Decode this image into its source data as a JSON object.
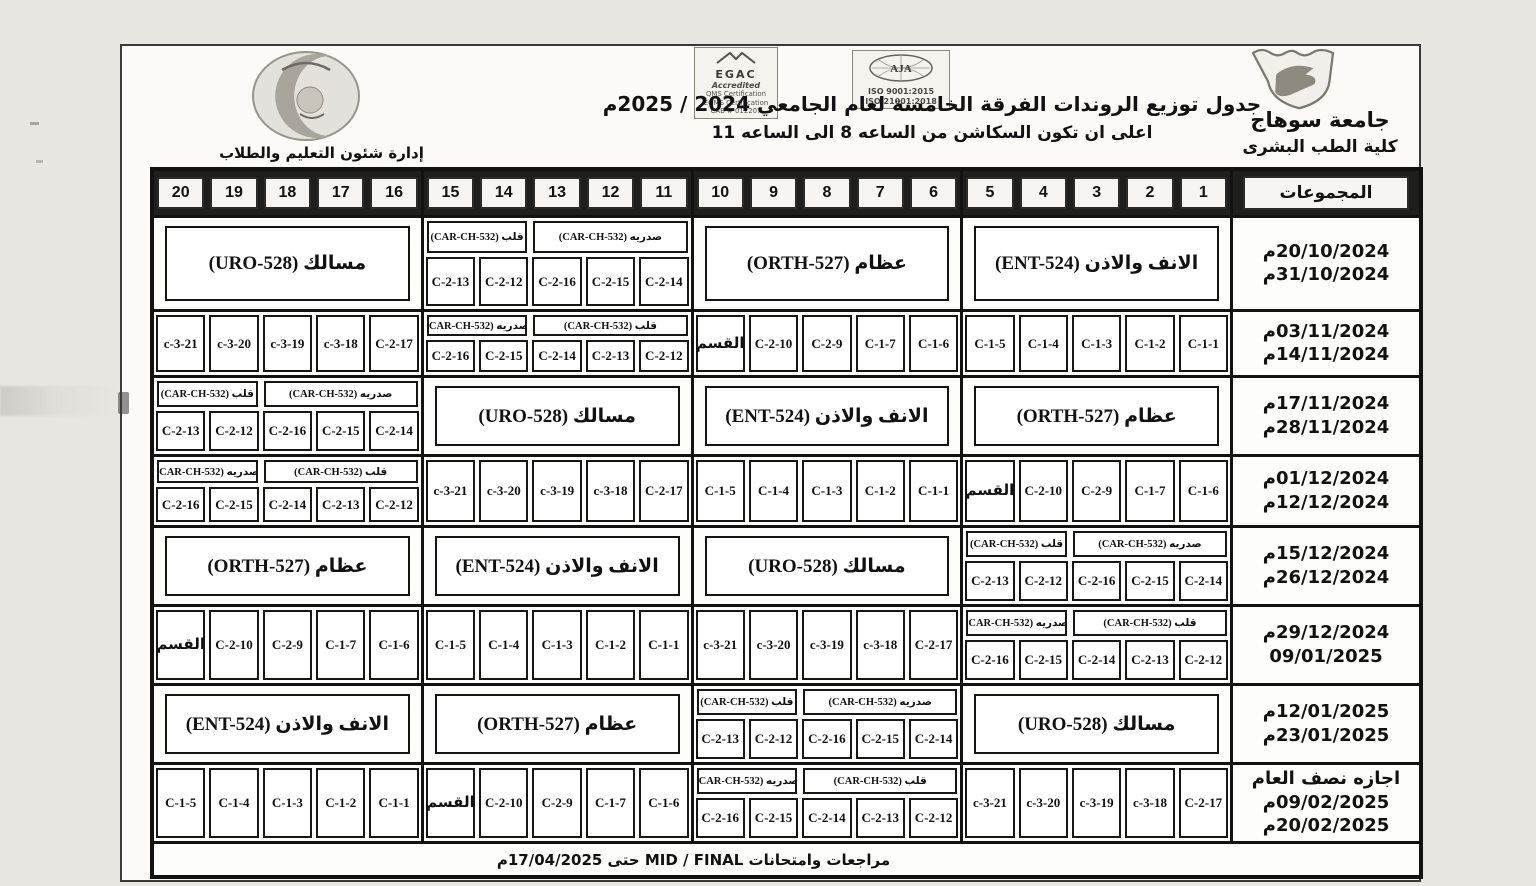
{
  "header": {
    "university": "جامعة سوهاج",
    "faculty": "كلية الطب البشرى",
    "title": "جدول توزيع الروندات  الفرقة الخامسة  لعام الجامعي 2024 / 2025م",
    "subtitle": "اعلى ان تكون السكاشن من الساعه 8 الى الساعه 11",
    "admin": "إدارة شئون التعليم والطلاب",
    "logos": {
      "egac_title": "EGAC",
      "egac_sub": "Accredited",
      "egac_lines": [
        "QMS Certification",
        "EOMS Certification",
        "CAB # 012207"
      ],
      "aja_title": "AJA",
      "aja_lines": [
        "ISO 9001:2015",
        "ISO 21001:2018"
      ]
    }
  },
  "table": {
    "groups_label": "المجموعات",
    "columns": [
      "1",
      "2",
      "3",
      "4",
      "5",
      "6",
      "7",
      "8",
      "9",
      "10",
      "11",
      "12",
      "13",
      "14",
      "15",
      "16",
      "17",
      "18",
      "19",
      "20"
    ],
    "footer": "مراجعات وامتحانات  MID / FINAL  حتى 17/04/2025م",
    "rows": [
      {
        "dates": [
          "20/10/2024م",
          "31/10/2024م"
        ],
        "groups": [
          {
            "type": "label",
            "text": "الانف والاذن (ENT-524)"
          },
          {
            "type": "label",
            "text": "عظام (ORTH-527)"
          },
          {
            "type": "carch",
            "heads": [
              {
                "text": "صدريه (CAR-CH-532)",
                "span": 3
              },
              {
                "text": "قلب (CAR-CH-532)",
                "span": 2
              }
            ],
            "cells": [
              "C-2-14",
              "C-2-15",
              "C-2-16",
              "C-2-12",
              "C-2-13"
            ]
          },
          {
            "type": "label",
            "text": "مسالك (URO-528)"
          }
        ]
      },
      {
        "dates": [
          "03/11/2024م",
          "14/11/2024م"
        ],
        "groups": [
          {
            "type": "cells",
            "cells": [
              "C-1-1",
              "C-1-2",
              "C-1-3",
              "C-1-4",
              "C-1-5"
            ]
          },
          {
            "type": "cells",
            "cells": [
              "C-1-6",
              "C-1-7",
              "C-2-9",
              "C-2-10",
              "القسم"
            ]
          },
          {
            "type": "carch",
            "heads": [
              {
                "text": "قلب (CAR-CH-532)",
                "span": 3
              },
              {
                "text": "صدريه (CAR-CH-532)",
                "span": 2
              }
            ],
            "cells": [
              "C-2-12",
              "C-2-13",
              "C-2-14",
              "C-2-15",
              "C-2-16"
            ]
          },
          {
            "type": "cells",
            "cells": [
              "C-2-17",
              "c-3-18",
              "c-3-19",
              "c-3-20",
              "c-3-21"
            ]
          }
        ]
      },
      {
        "dates": [
          "17/11/2024م",
          "28/11/2024م"
        ],
        "groups": [
          {
            "type": "label",
            "text": "عظام (ORTH-527)"
          },
          {
            "type": "label",
            "text": "الانف والاذن (ENT-524)"
          },
          {
            "type": "label",
            "text": "مسالك (URO-528)"
          },
          {
            "type": "carch",
            "heads": [
              {
                "text": "صدريه (CAR-CH-532)",
                "span": 3
              },
              {
                "text": "قلب (CAR-CH-532)",
                "span": 2
              }
            ],
            "cells": [
              "C-2-14",
              "C-2-15",
              "C-2-16",
              "C-2-12",
              "C-2-13"
            ]
          }
        ]
      },
      {
        "dates": [
          "01/12/2024م",
          "12/12/2024م"
        ],
        "groups": [
          {
            "type": "cells",
            "cells": [
              "C-1-6",
              "C-1-7",
              "C-2-9",
              "C-2-10",
              "القسم"
            ]
          },
          {
            "type": "cells",
            "cells": [
              "C-1-1",
              "C-1-2",
              "C-1-3",
              "C-1-4",
              "C-1-5"
            ]
          },
          {
            "type": "cells",
            "cells": [
              "C-2-17",
              "c-3-18",
              "c-3-19",
              "c-3-20",
              "c-3-21"
            ]
          },
          {
            "type": "carch",
            "heads": [
              {
                "text": "قلب (CAR-CH-532)",
                "span": 3
              },
              {
                "text": "صدريه (CAR-CH-532)",
                "span": 2
              }
            ],
            "cells": [
              "C-2-12",
              "C-2-13",
              "C-2-14",
              "C-2-15",
              "C-2-16"
            ]
          }
        ]
      },
      {
        "dates": [
          "15/12/2024م",
          "26/12/2024م"
        ],
        "groups": [
          {
            "type": "carch",
            "heads": [
              {
                "text": "صدريه (CAR-CH-532)",
                "span": 3
              },
              {
                "text": "قلب (CAR-CH-532)",
                "span": 2
              }
            ],
            "cells": [
              "C-2-14",
              "C-2-15",
              "C-2-16",
              "C-2-12",
              "C-2-13"
            ]
          },
          {
            "type": "label",
            "text": "مسالك (URO-528)"
          },
          {
            "type": "label",
            "text": "الانف والاذن (ENT-524)"
          },
          {
            "type": "label",
            "text": "عظام (ORTH-527)"
          }
        ]
      },
      {
        "dates": [
          "29/12/2024م",
          "09/01/2025"
        ],
        "groups": [
          {
            "type": "carch",
            "heads": [
              {
                "text": "قلب (CAR-CH-532)",
                "span": 3
              },
              {
                "text": "صدريه (CAR-CH-532)",
                "span": 2
              }
            ],
            "cells": [
              "C-2-12",
              "C-2-13",
              "C-2-14",
              "C-2-15",
              "C-2-16"
            ]
          },
          {
            "type": "cells",
            "cells": [
              "C-2-17",
              "c-3-18",
              "c-3-19",
              "c-3-20",
              "c-3-21"
            ]
          },
          {
            "type": "cells",
            "cells": [
              "C-1-1",
              "C-1-2",
              "C-1-3",
              "C-1-4",
              "C-1-5"
            ]
          },
          {
            "type": "cells",
            "cells": [
              "C-1-6",
              "C-1-7",
              "C-2-9",
              "C-2-10",
              "القسم"
            ]
          }
        ]
      },
      {
        "dates": [
          "12/01/2025م",
          "23/01/2025م"
        ],
        "groups": [
          {
            "type": "label",
            "text": "مسالك (URO-528)"
          },
          {
            "type": "carch",
            "heads": [
              {
                "text": "صدريه (CAR-CH-532)",
                "span": 3
              },
              {
                "text": "قلب (CAR-CH-532)",
                "span": 2
              }
            ],
            "cells": [
              "C-2-14",
              "C-2-15",
              "C-2-16",
              "C-2-12",
              "C-2-13"
            ]
          },
          {
            "type": "label",
            "text": "عظام (ORTH-527)"
          },
          {
            "type": "label",
            "text": "الانف والاذن (ENT-524)"
          }
        ]
      },
      {
        "dates": [
          "اجازه نصف العام",
          "09/02/2025م",
          "20/02/2025م"
        ],
        "groups": [
          {
            "type": "cells",
            "cells": [
              "C-2-17",
              "c-3-18",
              "c-3-19",
              "c-3-20",
              "c-3-21"
            ]
          },
          {
            "type": "carch",
            "heads": [
              {
                "text": "قلب (CAR-CH-532)",
                "span": 3
              },
              {
                "text": "صدريه (CAR-CH-532)",
                "span": 2
              }
            ],
            "cells": [
              "C-2-12",
              "C-2-13",
              "C-2-14",
              "C-2-15",
              "C-2-16"
            ]
          },
          {
            "type": "cells",
            "cells": [
              "C-1-6",
              "C-1-7",
              "C-2-9",
              "C-2-10",
              "القسم"
            ]
          },
          {
            "type": "cells",
            "cells": [
              "C-1-1",
              "C-1-2",
              "C-1-3",
              "C-1-4",
              "C-1-5"
            ]
          }
        ]
      }
    ]
  }
}
